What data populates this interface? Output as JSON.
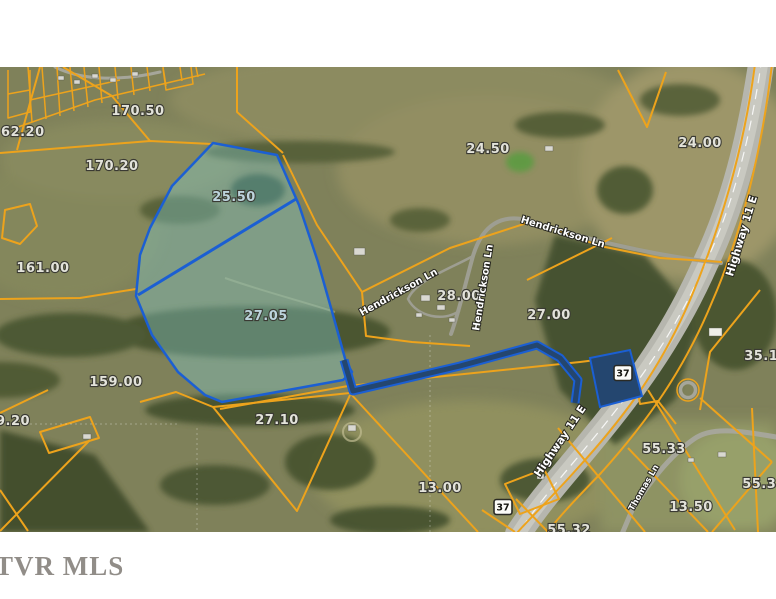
{
  "watermark": "TVR MLS",
  "map": {
    "parcels": {
      "p170_50": "170.50",
      "p62_20": "62.20",
      "p170_20": "170.20",
      "p25_50": "25.50",
      "p24_50": "24.50",
      "p24_00": "24.00",
      "p161_00": "161.00",
      "p27_05": "27.05",
      "p28_00": "28.00",
      "p27_00": "27.00",
      "p159_00": "159.00",
      "p9_20": "9.20",
      "p27_10": "27.10",
      "p13_00": "13.00",
      "p55_33": "55.33",
      "p13_50": "13.50",
      "p55_34": "55.34",
      "p55_32": "55.32",
      "p35_10": "35.10"
    },
    "streets": {
      "hendrickson_1": "Hendrickson Ln",
      "hendrickson_2": "Hendrickson Ln",
      "hendrickson_3": "Hendrickson Ln",
      "highway_1": "Highway 11 E",
      "highway_2": "Highway 11 E",
      "thomas": "Thomas Ln",
      "subdivision": "Whitetail Trl"
    },
    "shields": {
      "route_a": "37",
      "route_b": "37"
    },
    "colors": {
      "parcel_line": "#EDA31C",
      "highlight_line": "#1B5FD3",
      "highlight_fill": "rgba(130,200,200,0.40)",
      "road": "#B7B7AF"
    }
  }
}
